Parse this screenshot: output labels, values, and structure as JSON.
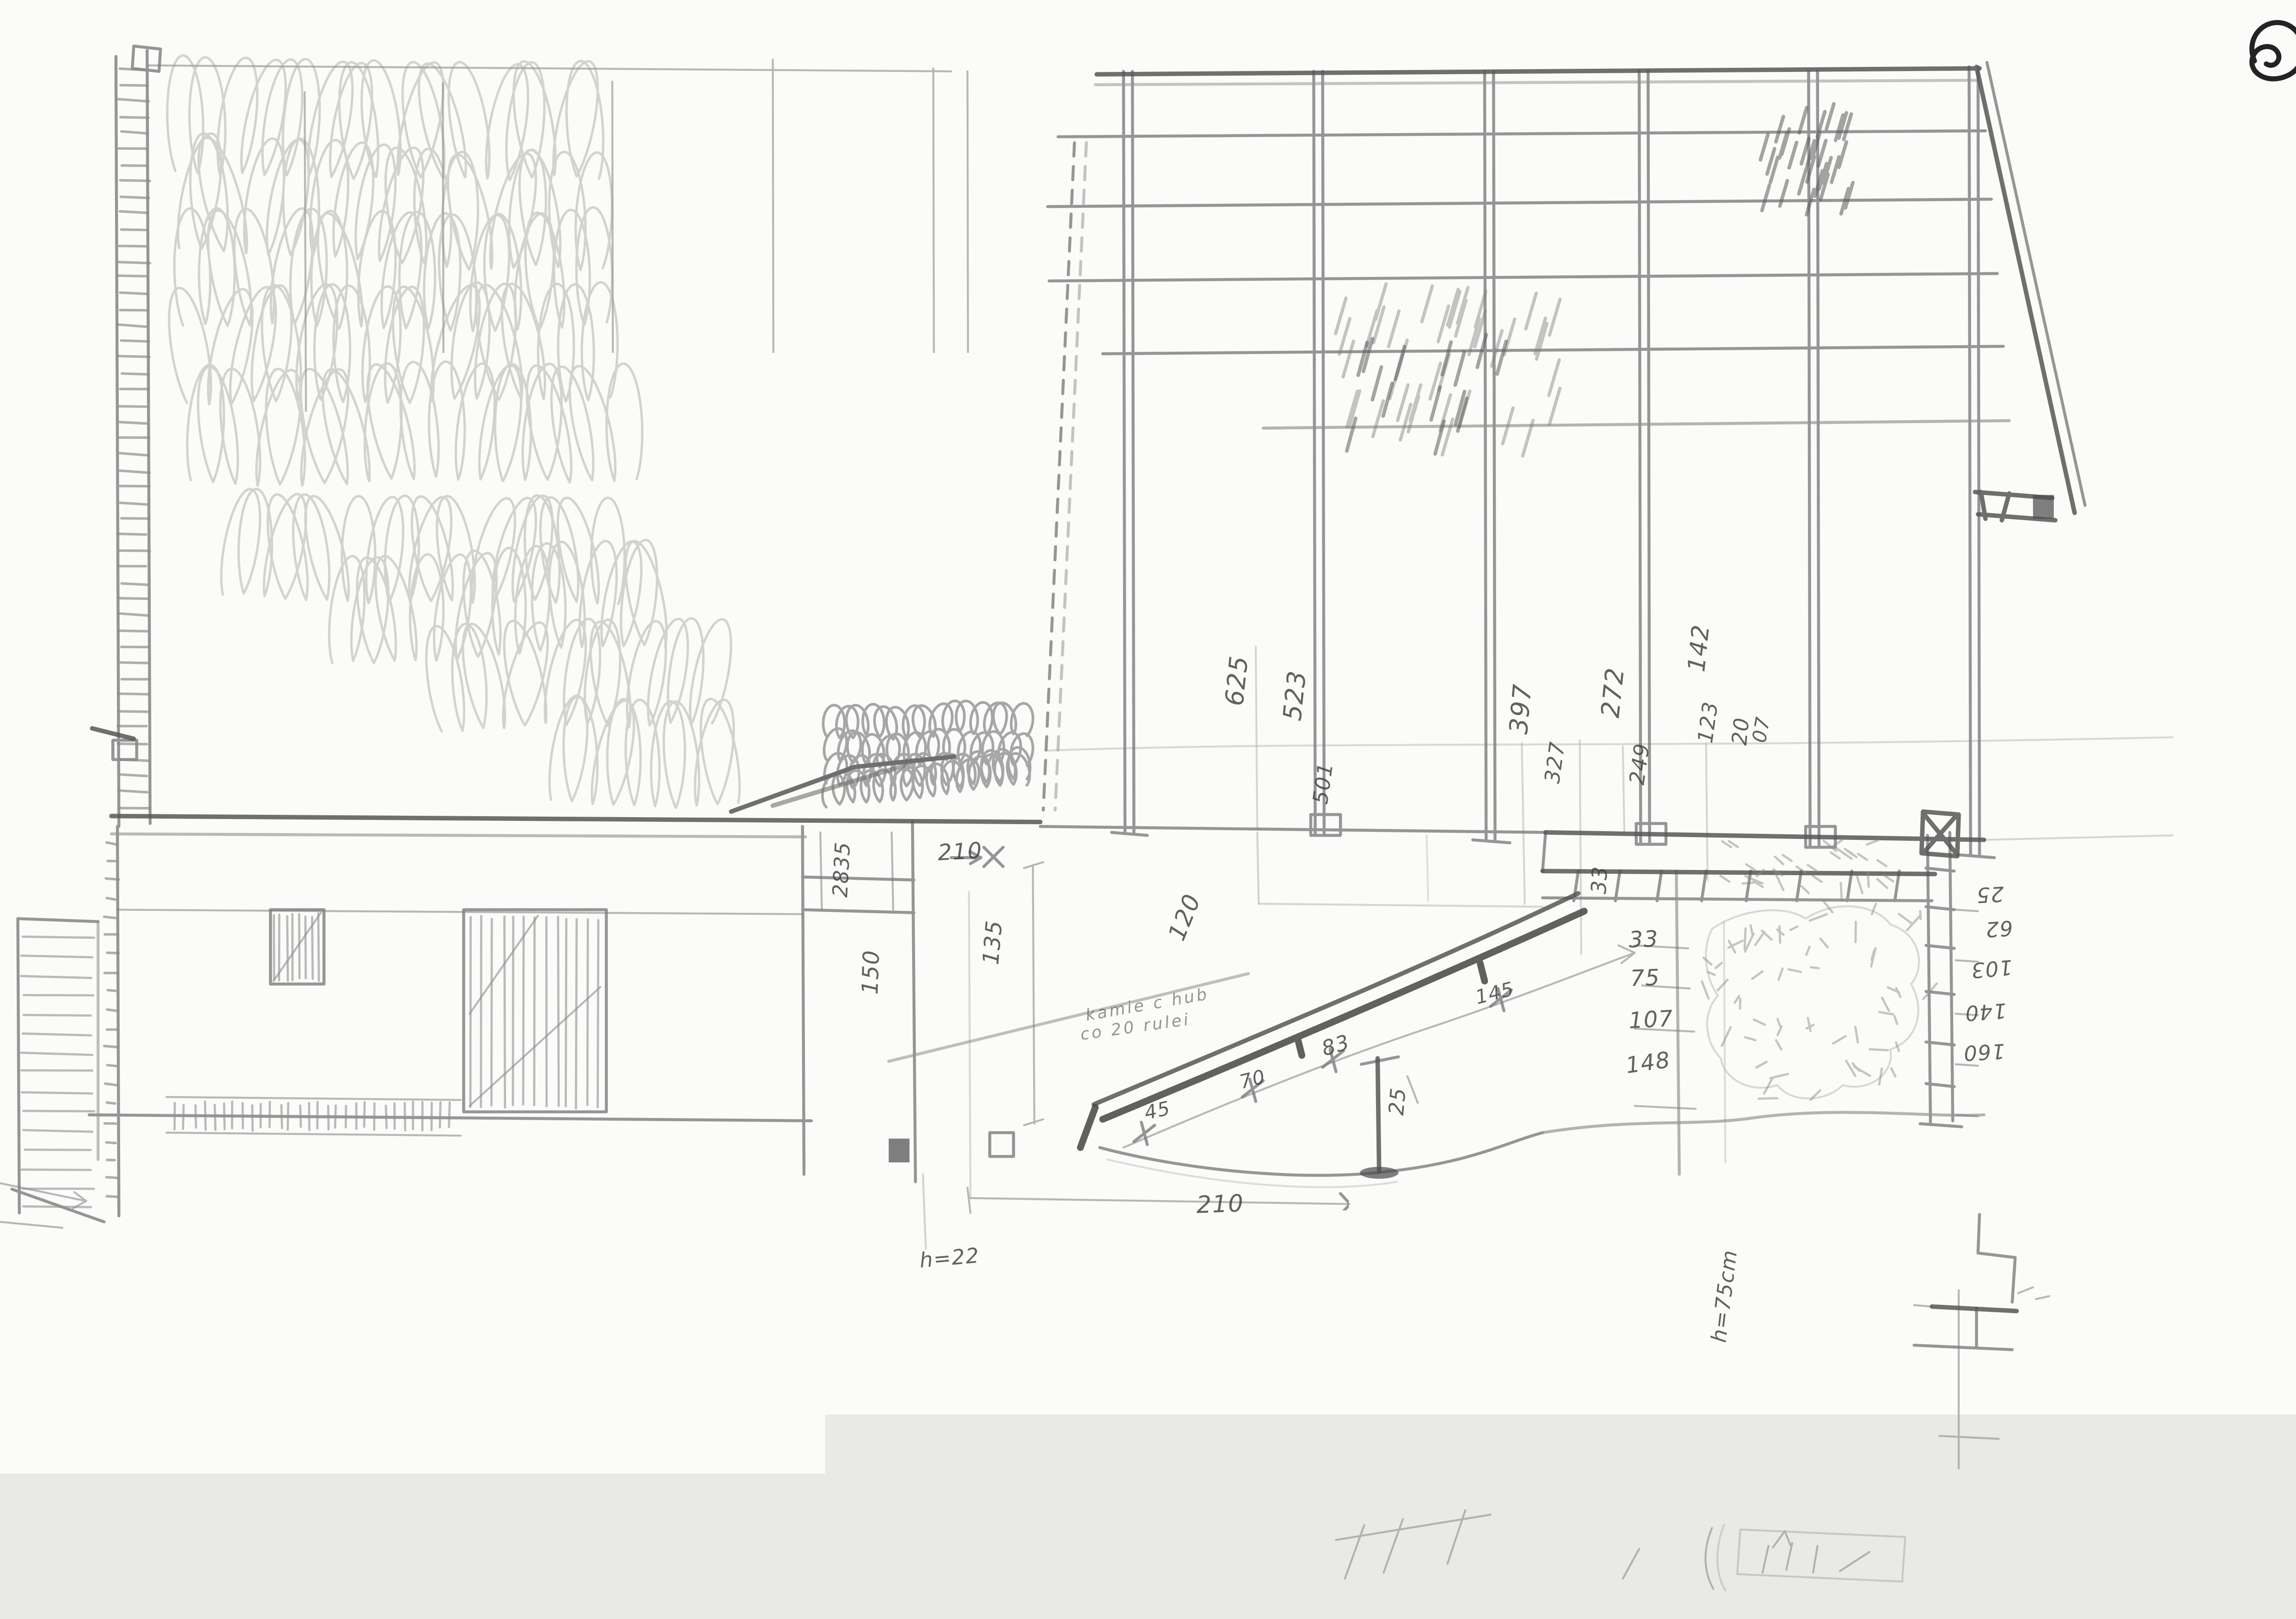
{
  "colors": {
    "paper": "#fbfbf9",
    "pencil_light": "#9b9b9b",
    "pencil": "#7c7c7c",
    "pencil_dark": "#565656",
    "ink": "#171717"
  },
  "corner": {
    "icon": "spiral-rotate-mark"
  },
  "labels": {
    "d625": "625",
    "d523": "523",
    "d501": "501",
    "d397": "397",
    "d327": "327",
    "d272": "272",
    "d249": "249",
    "d142": "142",
    "d123": "123",
    "d20": "20",
    "d07": "07",
    "d2835": "2835",
    "d210_top": "210",
    "d150": "150",
    "d135": "135",
    "d120": "120",
    "d45": "45",
    "d70": "70",
    "d83": "83",
    "d145": "145",
    "d25_stake": "25",
    "h22": "h=22",
    "d210_bottom": "210",
    "h75": "h=75cm",
    "d33_side": "33",
    "d33": "33",
    "d75": "75",
    "d107": "107",
    "d148": "148",
    "r25": "25",
    "r62": "62",
    "r103": "103",
    "r140": "140",
    "r160": "160",
    "s18_upper": "18",
    "s18_lower": "18",
    "plan157": "157"
  },
  "note": {
    "line1": "kamie c hub",
    "line2": "co 20 rulei"
  },
  "sums": {
    "left": [
      "37",
      "33",
      "42",
      "32",
      "41",
      "41",
      "37"
    ],
    "right": [
      "33",
      "44",
      "40"
    ],
    "total": "38,0"
  }
}
